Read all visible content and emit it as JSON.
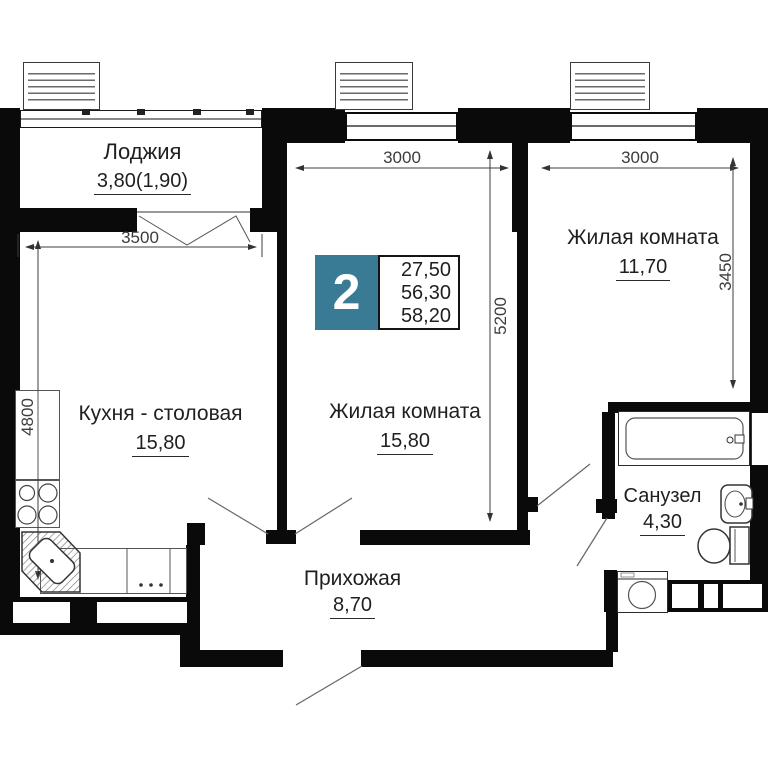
{
  "badge": {
    "rooms_count": "2",
    "area_values": [
      "27,50",
      "56,30",
      "58,20"
    ]
  },
  "rooms": {
    "loggia": {
      "name": "Лоджия",
      "area": "3,80(1,90)"
    },
    "kitchen": {
      "name": "Кухня - столовая",
      "area": "15,80"
    },
    "living_center": {
      "name": "Жилая комната",
      "area": "15,80"
    },
    "living_right": {
      "name": "Жилая комната",
      "area": "11,70"
    },
    "bathroom": {
      "name": "Санузел",
      "area": "4,30"
    },
    "hallway": {
      "name": "Прихожая",
      "area": "8,70"
    }
  },
  "dims": {
    "loggia_width": "3500",
    "living_center_width": "3000",
    "living_right_width": "3000",
    "living_center_depth": "5200",
    "living_right_depth": "3450",
    "kitchen_depth": "4800"
  },
  "colors": {
    "badge_teal": "#397b94",
    "wall": "#0a0a0a"
  }
}
